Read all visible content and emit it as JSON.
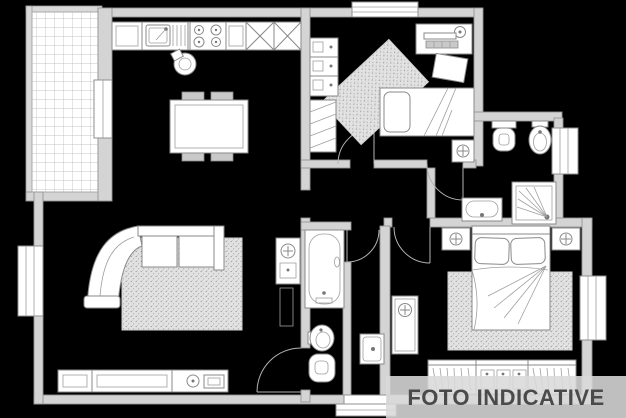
{
  "watermark": {
    "label": "FOTO INDICATIVE"
  },
  "colors": {
    "background": "#000000",
    "walls": "#d4d4d4",
    "wall_stroke": "#949494",
    "furniture_fill": "#ffffff",
    "furniture_stroke": "#8a8a8a",
    "rug_texture": "#e2e2e2",
    "banner_bg": "#d9d9d9",
    "banner_text": "#4a4a4a",
    "terrace_grid": "#b4b4b4"
  },
  "plan": {
    "type": "apartment-floor-plan",
    "rooms": [
      "terrace",
      "kitchen-living-room",
      "bedroom-1",
      "bathroom-1",
      "bathroom-2",
      "hallway",
      "master-bedroom"
    ],
    "symbols": [
      "kitchen-sink-icon",
      "stove-icon",
      "dining-table-icon",
      "sofa-icon",
      "rug-icon",
      "tv-cabinet-icon",
      "washing-column-icon",
      "bookshelf-icon",
      "single-bed-icon",
      "desk-icon",
      "toilet-icon",
      "bidet-icon",
      "shower-icon",
      "washbasin-icon",
      "bathtub-icon",
      "double-bed-icon",
      "nightstand-icon",
      "wardrobe-icon",
      "window-icon",
      "door-icon",
      "entrance-step-icon"
    ]
  }
}
